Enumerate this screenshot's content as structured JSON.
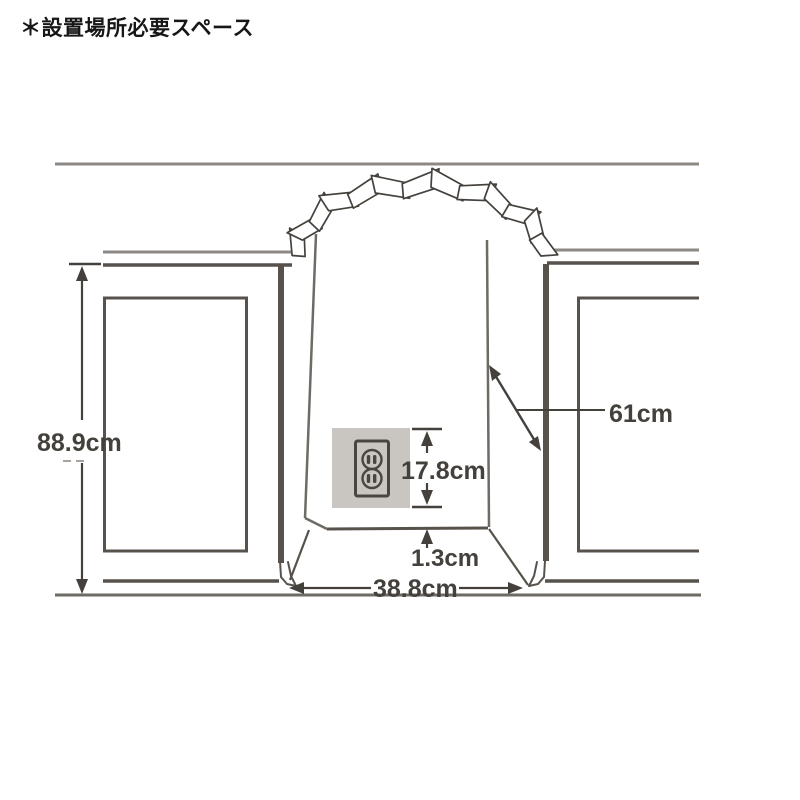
{
  "page": {
    "title": "＊設置場所必要スペース"
  },
  "diagram": {
    "name": "installation-space-diagram",
    "dimensions": {
      "cabinet_height": "88.9cm",
      "depth": "61cm",
      "outlet_plate_height": "17.8cm",
      "outlet_bottom_gap": "1.3cm",
      "alcove_width": "38.8cm"
    },
    "icons": [
      {
        "name": "duplex-outlet-icon"
      }
    ],
    "colors": {
      "line_dark": "#57524c",
      "line_light": "#8d8984",
      "line_mid": "#6e6a64",
      "dimension": "#44403c",
      "outlet_panel_bg": "#c9c5c0",
      "background": "#ffffff"
    }
  }
}
